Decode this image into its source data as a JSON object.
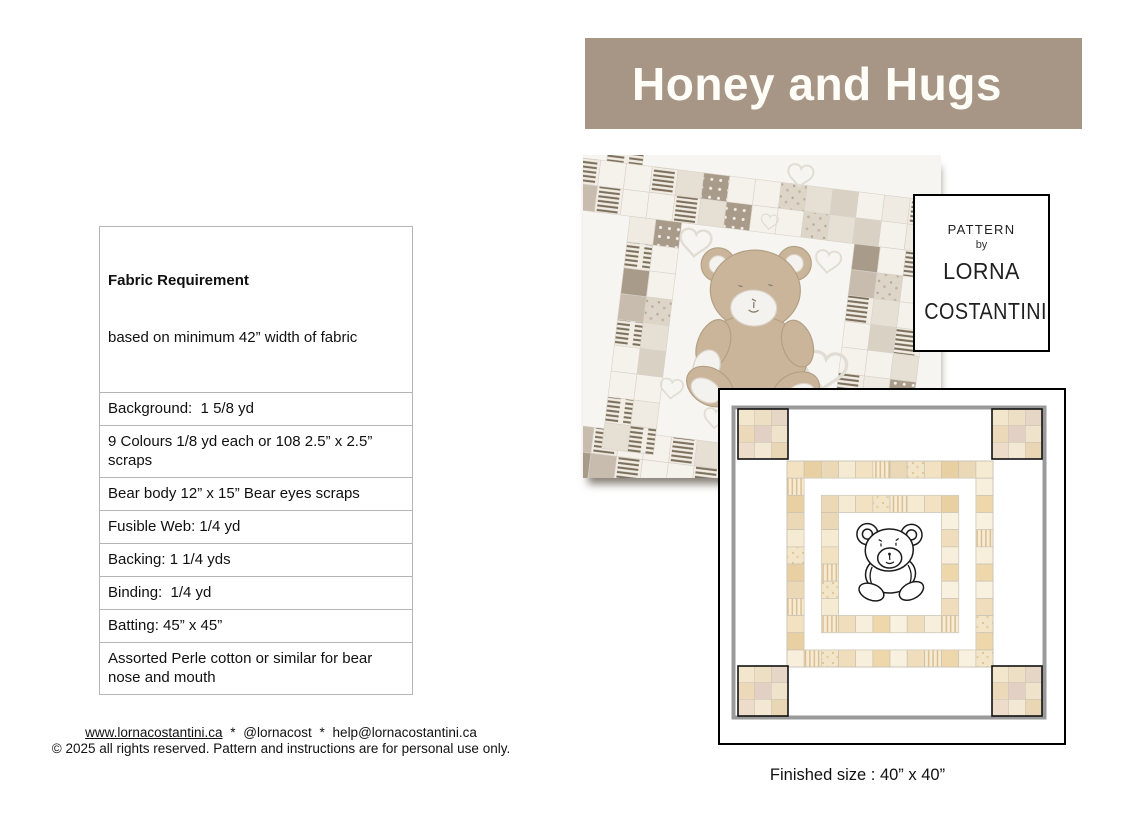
{
  "header": {
    "title": "Honey and Hugs",
    "bg_color": "#a79685",
    "text_color": "#fffdf8"
  },
  "fabric_table": {
    "rows": [
      {
        "bold": "Fabric Requirement",
        "rest": "based on minimum 42” width of fabric"
      },
      {
        "text": "Background:  1 5/8 yd"
      },
      {
        "text": "9 Colours 1/8 yd each or 108 2.5” x 2.5” scraps"
      },
      {
        "text": "Bear body 12” x 15” Bear eyes scraps"
      },
      {
        "text": "Fusible Web: 1/4 yd"
      },
      {
        "text": "Backing: 1 1/4 yds"
      },
      {
        "text": "Binding:  1/4 yd"
      },
      {
        "text": "Batting: 45” x 45”"
      },
      {
        "text": "Assorted Perle cotton or similar for bear nose and mouth"
      }
    ]
  },
  "pattern_box": {
    "line1": "PATTERN",
    "line2": "by",
    "line3": "LORNA",
    "line4": "COSTANTINI"
  },
  "diagram": {
    "caption": "Finished size : 40” x 40”"
  },
  "footer": {
    "website": "www.lornacostantini.ca",
    "separator": "*",
    "handle": "@lornacost",
    "email": "help@lornacostantini.ca",
    "copyright": "© 2025 all rights reserved. Pattern and instructions are for personal use only."
  },
  "palette": {
    "banner_bg": "#a79685",
    "banner_text": "#fffdf8",
    "diagram_border_gray": "#9a9a9a",
    "bear_tan": "#cab59b",
    "ring_colors": [
      "#f5ead2",
      "#eed7ab",
      "#f3e2c2",
      "#f9f1e0",
      "#e9d0a2",
      "#f0ddbb",
      "#ead8b6",
      "#f7eedb"
    ],
    "ninepatch_colors": [
      "#f2e7cd",
      "#eddfc4",
      "#e6d6c6",
      "#ecd9b9",
      "#e2d0c5",
      "#f0e3cc",
      "#eddcca",
      "#f2e8d4",
      "#e9d6b5"
    ],
    "photo_patch_colors": [
      "#f5f2ec",
      "#f5f2ec",
      "#e6dfd4",
      "st",
      "#f5f2ec",
      "#a99b8a",
      "dt",
      "#efebe2",
      "st",
      "#d9d1c4",
      "#f5f2ec",
      "fl",
      "#c7bcae",
      "#f5f2ec",
      "st",
      "#e6dfd4"
    ]
  }
}
